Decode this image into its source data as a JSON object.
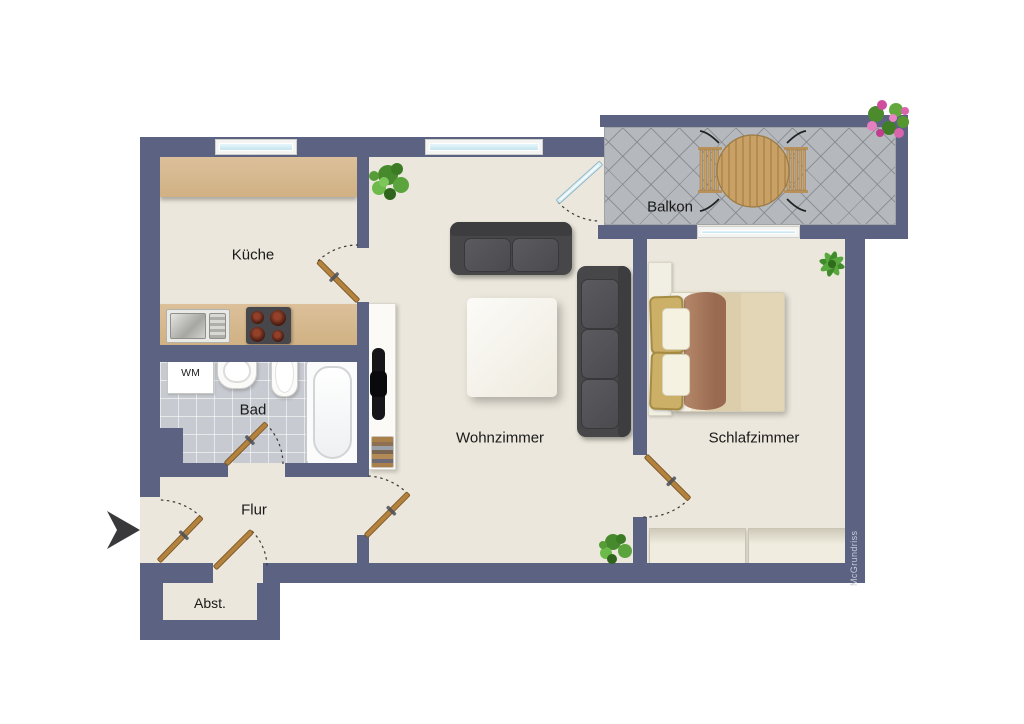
{
  "document": {
    "type": "apartment floor plan"
  },
  "rooms": {
    "kueche": {
      "label": "Küche"
    },
    "bad": {
      "label": "Bad"
    },
    "flur": {
      "label": "Flur"
    },
    "abstellraum": {
      "label": "Abst."
    },
    "wohnzimmer": {
      "label": "Wohnzimmer"
    },
    "schlafzimmer": {
      "label": "Schlafzimmer"
    },
    "balkon": {
      "label": "Balkon"
    }
  },
  "appliances": {
    "washing_machine": {
      "label": "WM"
    }
  },
  "watermark": {
    "label": "McGrundriss"
  },
  "entrance": {
    "marker": "arrow-right-icon"
  },
  "doors": [
    "entrance",
    "abstellraum",
    "bad",
    "kueche",
    "wohnzimmer-flur",
    "schlafzimmer",
    "balkon-glass"
  ],
  "windows": [
    "kueche",
    "wohnzimmer",
    "schlafzimmer"
  ],
  "furniture": {
    "kueche": [
      "counter-top",
      "counter-bottom",
      "sink",
      "stove-4-burners"
    ],
    "bad": [
      "washing-machine",
      "basin",
      "toilet",
      "bathtub"
    ],
    "wohnzimmer": [
      "sofa-2-seat",
      "sofa-3-seat",
      "coffee-table",
      "tv-sideboard",
      "book-stack",
      "plant",
      "plant"
    ],
    "schlafzimmer": [
      "double-bed",
      "wardrobe-2-units",
      "plant"
    ],
    "balkon": [
      "round-dining-table",
      "chair",
      "chair",
      "flower-planter"
    ]
  },
  "colors": {
    "wall": "#5c6282",
    "floor": "#ebe7dc",
    "bath_tile": "#c7cbd1",
    "balcony_tile": "#b5b8bc",
    "kitchen_counter": "#d6b68e",
    "sofa": "#47474a",
    "door_wood": "#b3823f",
    "window_glass": "#cfe9f2",
    "bed_blanket": "#a97c5f",
    "background": "#ffffff"
  }
}
